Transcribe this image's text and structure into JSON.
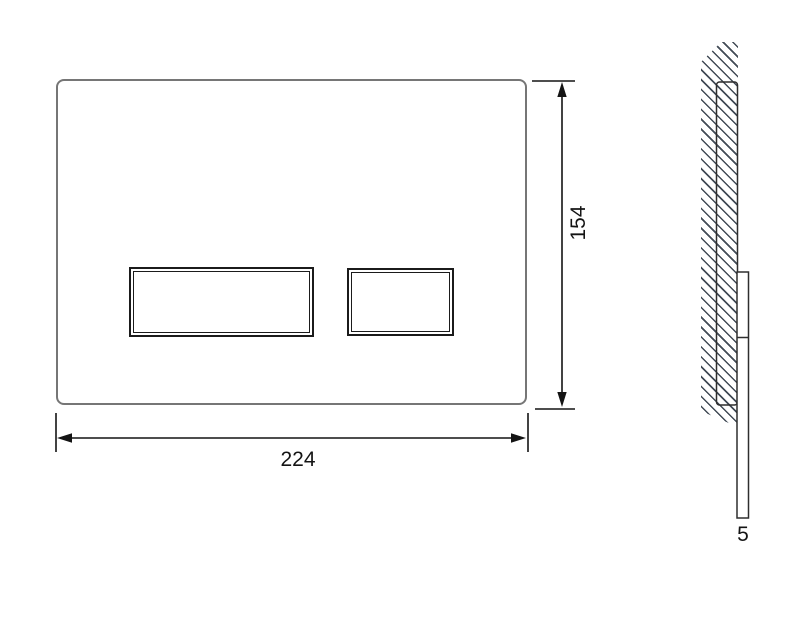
{
  "drawing": {
    "kind": "technical-drawing",
    "dimensions": {
      "width_label": "224",
      "height_label": "154",
      "depth_label": "5"
    },
    "colors": {
      "background": "#ffffff",
      "plate_outline": "#767676",
      "button_outline": "#1b1b1b",
      "dimension_line": "#141414",
      "wall_hatch": "#424b56"
    }
  }
}
